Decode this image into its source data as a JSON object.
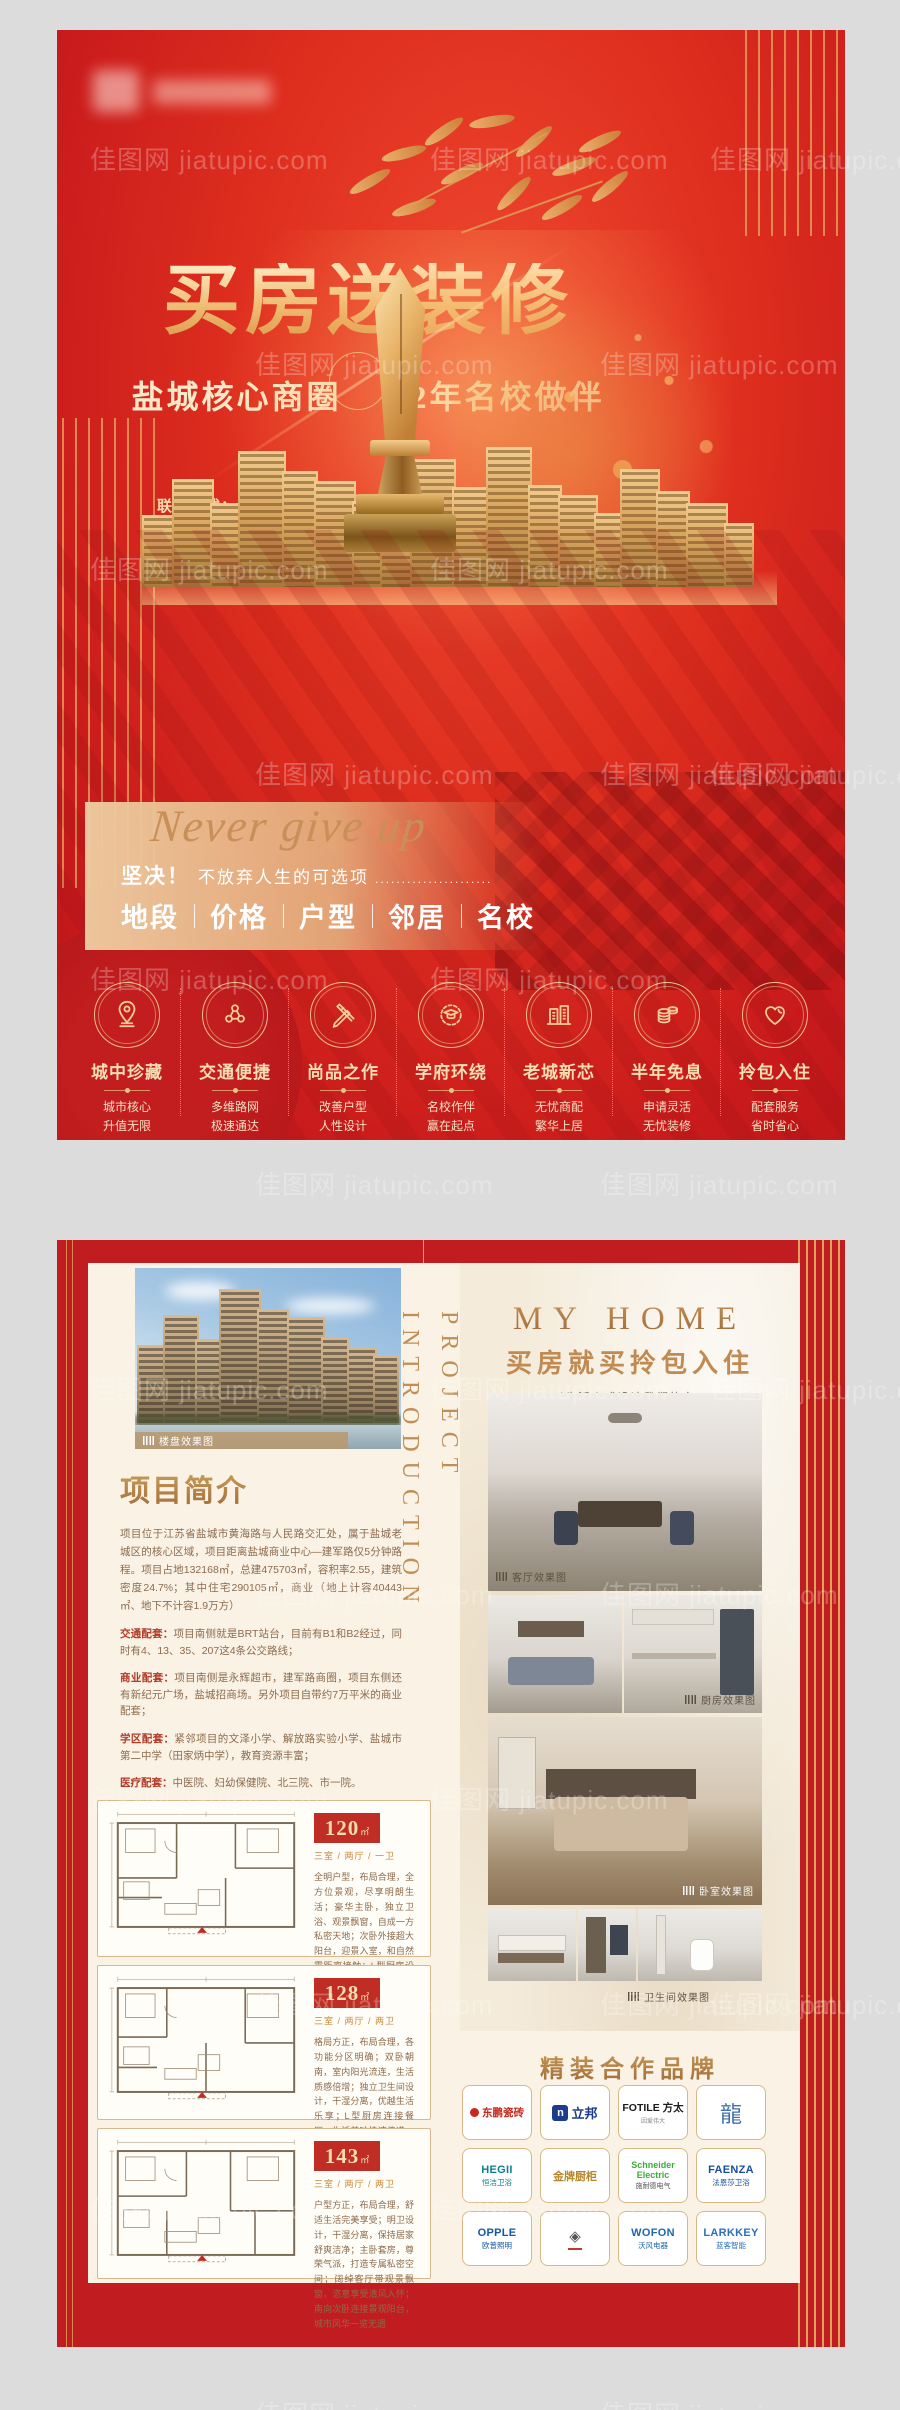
{
  "colors": {
    "accent_red": "#c11d20",
    "gold": "#e9b879",
    "panel_cream": "#f9f2e5"
  },
  "watermark": {
    "text": "佳图网 jiatupic.com"
  },
  "page1": {
    "title": "买房送装修",
    "subtitle_left": "盐城核心商圈",
    "subtitle_right": "12年名校做伴",
    "contact_label": "联系方式：",
    "phone": "0005  8888  8888",
    "address_label": "楼盘地址：",
    "address": "人民路与黄海路交界处（原老工学院地块）",
    "slogan": {
      "en": "Never give up",
      "cn_bold": "坚决！",
      "cn": "不放弃人生的可选项",
      "dots": "......................"
    },
    "keywords": [
      "地段",
      "价格",
      "户型",
      "邻居",
      "名校"
    ],
    "features": [
      {
        "icon": "map-pin-icon",
        "title": "城中珍藏",
        "line1": "城市核心",
        "line2": "升值无限"
      },
      {
        "icon": "network-icon",
        "title": "交通便捷",
        "line1": "多维路网",
        "line2": "极速通达"
      },
      {
        "icon": "design-tools-icon",
        "title": "尚品之作",
        "line1": "改善户型",
        "line2": "人性设计"
      },
      {
        "icon": "graduation-icon",
        "title": "学府环绕",
        "line1": "名校作伴",
        "line2": "赢在起点"
      },
      {
        "icon": "buildings-icon",
        "title": "老城新芯",
        "line1": "无忧商配",
        "line2": "繁华上居"
      },
      {
        "icon": "coins-icon",
        "title": "半年免息",
        "line1": "申请灵活",
        "line2": "无忧装修"
      },
      {
        "icon": "heart-icon",
        "title": "拎包入住",
        "line1": "配套服务",
        "line2": "省时省心"
      }
    ]
  },
  "page2": {
    "tag": "轻 / 奢 / 风",
    "vertical_title": {
      "line1": "PROJECT",
      "line2": "INTRODUCTION"
    },
    "myhome": {
      "title": "MY HOME",
      "subtitle": "买房就买拎包入住",
      "desc1": "以生活方式设计我们的家，",
      "desc2": "在家过好自己的生活。"
    },
    "captions": {
      "building": "楼盘效果图",
      "living": "客厅效果图",
      "kitchen": "厨房效果图",
      "bedroom": "卧室效果图",
      "bath": "卫生间效果图"
    },
    "intro": {
      "heading": "项目简介",
      "para": "项目位于江苏省盐城市黄海路与人民路交汇处，属于盐城老城区的核心区域，项目距离盐城商业中心—建军路仅5分钟路程。项目占地132168㎡，总建475703㎡，容积率2.55，建筑密度24.7%；其中住宅290105㎡，商业（地上计容40443㎡、地下不计容1.9万方）"
    },
    "supporting": [
      {
        "label": "交通配套：",
        "text": "项目南侧就是BRT站台，目前有B1和B2经过，同时有4、13、35、207这4条公交路线；"
      },
      {
        "label": "商业配套：",
        "text": "项目南侧是永辉超市，建军路商圈，项目东侧还有新纪元广场，盐城招商场。另外项目自带约7万平米的商业配套；"
      },
      {
        "label": "学区配套：",
        "text": "紧邻项目的文泽小学、解放路实验小学、盐城市第二中学（田家炳中学），教育资源丰富；"
      },
      {
        "label": "医疗配套：",
        "text": "中医院、妇幼保健院、北三院、市一院。"
      }
    ],
    "pure": {
      "en": "PURE / NATURAL",
      "cn": "纯净/自然",
      "desc_cn": "卸下疲惫，回归幸福的本质。",
      "desc_en": "REMOVE FATIGUE AND RETURN TO THE ESSENCE OF HAPPINESS."
    },
    "floorplans": [
      {
        "area": "120",
        "unit": "㎡",
        "spec": "三室 / 两厅 / 一卫",
        "desc": "全明户型，布局合理，全方位景观，尽享明朗生活；豪华主卧，独立卫浴、观景飘窗，自成一方私密天地；次卧外接超大阳台，迎景入室，和自然零距离接触；L型厨房设计，洗、切、炒科学动线，美味纵享"
      },
      {
        "area": "128",
        "unit": "㎡",
        "spec": "三室 / 两厅 / 两卫",
        "desc": "格局方正，布局合理，各功能分区明确；双卧朝南，室内阳光流连，生活质感倍增；独立卫生间设计，干湿分离，优越生活乐享；L型厨房连接餐厅，生活美味快速传递；书房或客卧，灵动选择，自由随心"
      },
      {
        "area": "143",
        "unit": "㎡",
        "spec": "三室 / 两厅 / 两卫",
        "desc": "户型方正，布局合理，舒适生活完美享受；明卫设计，干湿分离，保持居家舒爽洁净；主卧套房，尊荣气派，打造专属私密空间；阔绰客厅带观景飘窗，恣意享受清风入怀；南向次卧连接景观阳台，城市风华一览无遗"
      }
    ],
    "brands": {
      "heading": "精装合作品牌",
      "items": [
        {
          "id": "dongpeng",
          "en": "",
          "cn": "东鹏瓷砖",
          "color": "#c8281e",
          "mark": "swoosh"
        },
        {
          "id": "nippon",
          "en": "n",
          "cn": "立邦",
          "color": "#1e3c8c",
          "mark": "n-square"
        },
        {
          "id": "fotile",
          "en": "FOTILE",
          "cn": "方太",
          "tagline": "因爱伟大",
          "color": "#1b1b1b",
          "mark": ""
        },
        {
          "id": "dragon",
          "en": "",
          "cn": "",
          "color": "#2e62a8",
          "mark": "dragon-emblem"
        },
        {
          "id": "hegii",
          "en": "HEGII",
          "cn": "恒洁卫浴",
          "color": "#0d7f8e",
          "mark": ""
        },
        {
          "id": "goldkitchen",
          "en": "",
          "cn": "金牌厨柜",
          "color": "#b6862c",
          "mark": ""
        },
        {
          "id": "schneider",
          "en": "Schneider Electric",
          "cn": "施耐德电气",
          "color": "#3dab37",
          "mark": ""
        },
        {
          "id": "faenza",
          "en": "FAENZA",
          "cn": "法恩莎卫浴",
          "color": "#1a4fa0",
          "mark": ""
        },
        {
          "id": "opple",
          "en": "OPPLE",
          "cn": "欧普照明",
          "color": "#1557a5",
          "mark": ""
        },
        {
          "id": "seal",
          "en": "",
          "cn": "",
          "color": "#555555",
          "mark": "seal-emblem"
        },
        {
          "id": "wofon",
          "en": "WOFON",
          "cn": "沃风电器",
          "color": "#1f66b0",
          "mark": ""
        },
        {
          "id": "larkkey",
          "en": "LARKKEY",
          "cn": "蓝客智能",
          "color": "#2b6fc2",
          "mark": ""
        }
      ]
    }
  }
}
